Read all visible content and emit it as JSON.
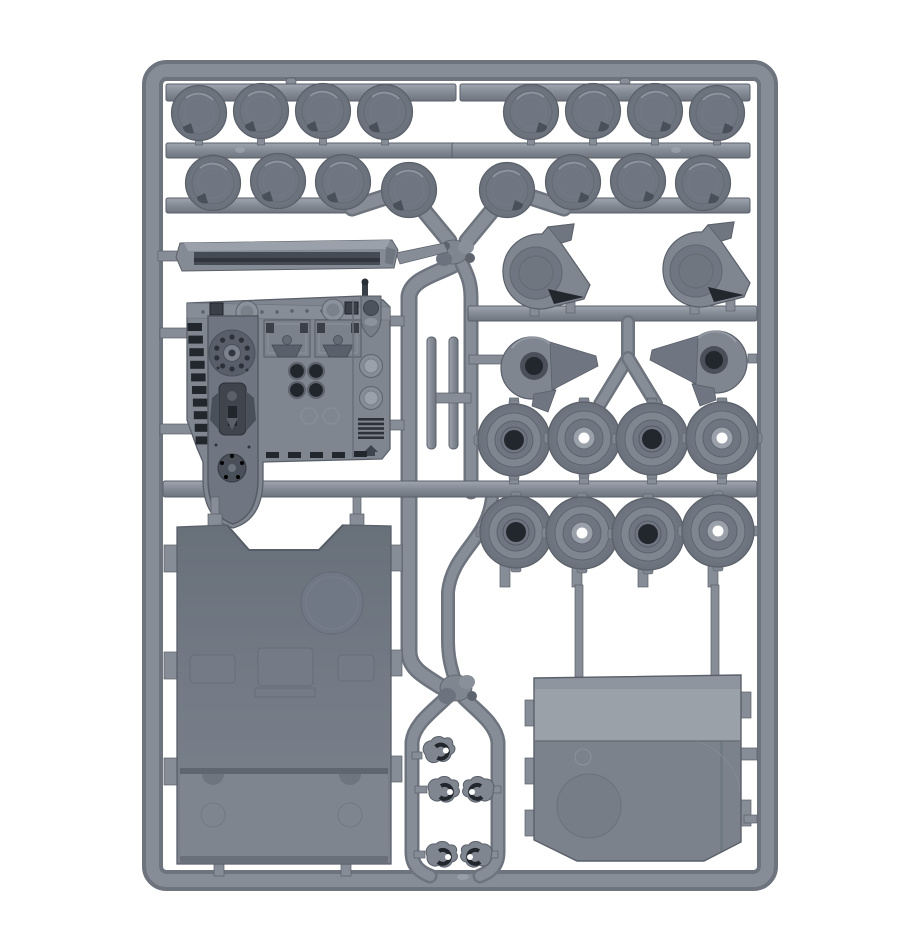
{
  "photo": {
    "subject": "injection-moulded plastic model kit sprue (tank vehicle frame) photographed on a plain white background",
    "plastic_color_name": "grey",
    "background": "#ffffff"
  },
  "colors": {
    "bg": "#ffffff",
    "run-hi": "#a0a6af",
    "run-mid": "#878d97",
    "run-lo": "#6e747e",
    "edge": "#5a606a",
    "part": "#7f8690",
    "part-dk": "#6f7681",
    "detail": "#3a3f48",
    "detail-dk": "#22262d",
    "panel-dk": "#68707a",
    "panel-md": "#7b828c",
    "panel-lt": "#9ba1a9",
    "cap-in": "#848b96",
    "cap-out": "#6b717b"
  },
  "sprue": {
    "parts": [
      {
        "name": "round hatch cap",
        "count": 16
      },
      {
        "name": "road wheel hub (closed centre)",
        "count": 4
      },
      {
        "name": "road wheel hub (open centre)",
        "count": 4
      },
      {
        "name": "exhaust / blower housing",
        "count": 2
      },
      {
        "name": "drive housing with fin",
        "count": 2
      },
      {
        "name": "towing hook",
        "count": 5
      },
      {
        "name": "track guard rail",
        "count": 1
      },
      {
        "name": "detailed front access panel",
        "count": 1
      },
      {
        "name": "large hull panel",
        "count": 1
      },
      {
        "name": "rear hatch panel",
        "count": 1
      },
      {
        "name": "antenna rod",
        "count": 2
      }
    ]
  }
}
